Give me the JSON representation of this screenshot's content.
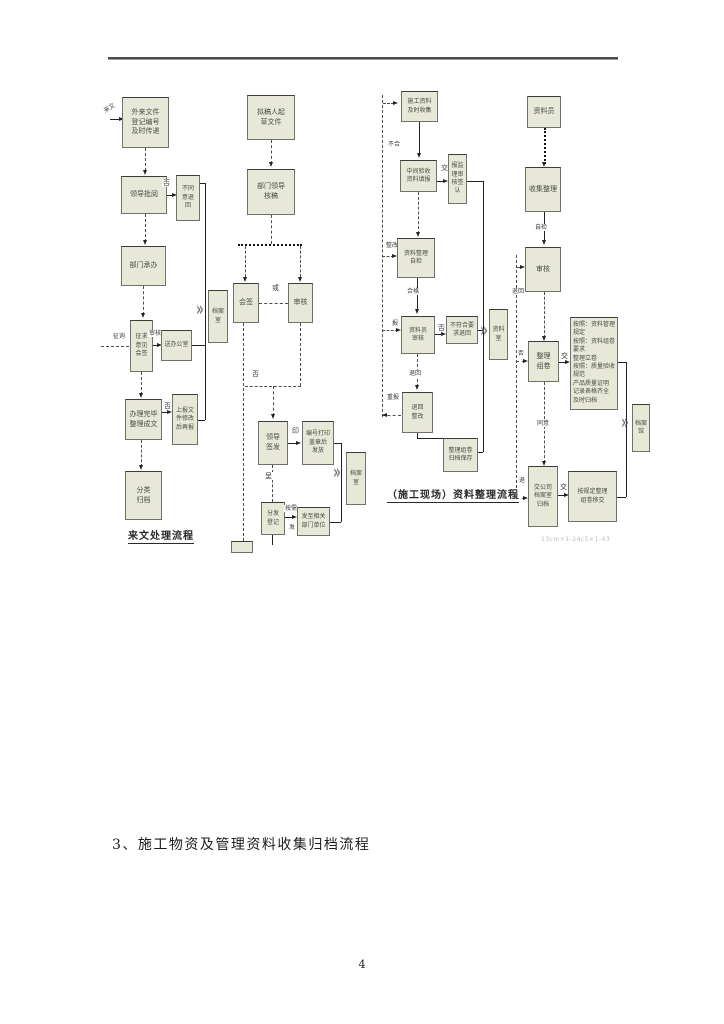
{
  "page": {
    "heading": "3、施工物资及管理资料收集归档流程",
    "page_number": "4",
    "footnote": "13cm×1-24c5×1-43"
  },
  "chart_a": {
    "caption": "来文处理流程",
    "source_label": "来文",
    "boxes": {
      "incoming": "外来文件\n登记编号\n及时传递",
      "leader_review": "领导批阅",
      "reject_return": "不同\n意退\n回",
      "dept_handle": "部门承办",
      "consult_sign": "征求\n意见\n会签",
      "to_office": "送办公室",
      "finish_doc": "办理完毕\n整理成文",
      "resubmit": "上报文\n件修改\n后再报",
      "classify_file": "分类\n归档",
      "archive": "档案\n室"
    },
    "labels": {
      "no1": "否",
      "consult": "征询",
      "review": "审核",
      "no2": "否"
    }
  },
  "chart_b": {
    "boxes": {
      "draft": "拟稿人起\n草文件",
      "dept_check": "部门领导\n核稿",
      "countersign": "会签",
      "proof": "审核",
      "sign_issue": "领导\n签发",
      "stamp_issue": "编号打印\n盖章后\n发放",
      "register": "分发\n登记",
      "send_out": "发至相关\n部门单位",
      "archive": "档案\n室",
      "terminator": ""
    },
    "labels": {
      "or": "或",
      "no": "否",
      "cheng": "呈",
      "yin": "印",
      "per_need": "按需",
      "fa": "发"
    }
  },
  "chart_c": {
    "caption": "（施工现场）资料整理流程",
    "boxes": {
      "collect": "施工资料\n及时收集",
      "mid_accept": "中间验收\n资料填报",
      "supervisor": "报监\n理审\n核签\n认",
      "self_check": "资料整理\n自检",
      "clerk_check": "资料员\n审核",
      "nonconform": "不符合要\n求退回",
      "return_fix": "退回\n整改",
      "bind_file": "整理组卷\n归档保存",
      "archive": "资料\n室"
    },
    "labels": {
      "unqualified": "不合",
      "jiao": "交",
      "rectify": "整改",
      "qualified": "合格",
      "bao": "报",
      "fou": "否",
      "tuihui": "退回",
      "chongbao": "重报"
    }
  },
  "chart_d": {
    "boxes": {
      "clerk": "资料员",
      "collect": "收集整理",
      "dept_audit": "审核",
      "make_volume": "整理\n组卷",
      "requirements": "按照：资料管理规定\n按照：资料组卷要求\n整理立卷\n按照：质量验收规范\n产品质量证明\n记录表格齐全\n及时归档",
      "to_archive_room": "交公司\n档案室\n归档",
      "handover": "按规定整理\n组卷移交",
      "archive": "档案\n馆"
    },
    "labels": {
      "self_check": "自检",
      "return1": "退回",
      "fou": "否",
      "jiao1": "交",
      "agree": "同意",
      "tui": "退",
      "jiao2": "交"
    }
  }
}
